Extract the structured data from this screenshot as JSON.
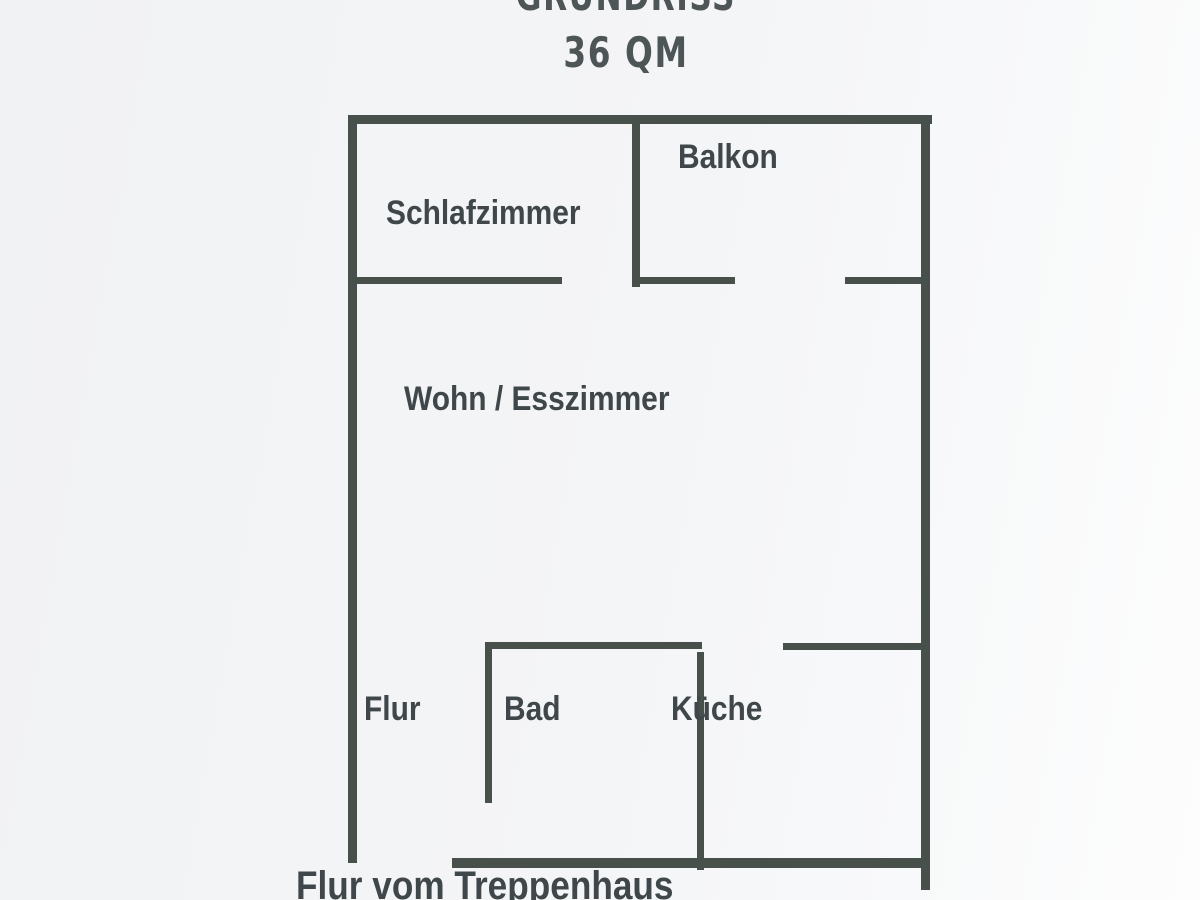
{
  "title": {
    "heading": "GRUNDRISS",
    "area": "36 QM"
  },
  "rooms": {
    "balkon": {
      "label": "Balkon"
    },
    "schlafzimmer": {
      "label": "Schlafzimmer"
    },
    "wohn_esszimmer": {
      "label": "Wohn / Esszimmer"
    },
    "flur": {
      "label": "Flur"
    },
    "bad": {
      "label": "Bad"
    },
    "kueche": {
      "label": "Küche"
    },
    "treppenhaus": {
      "label": "Flur vom Treppenhaus"
    }
  },
  "colors": {
    "wall": "#47504b",
    "label_text": "#3f474a",
    "title_text": "#4e5556",
    "background": "#f4f5f7"
  },
  "plan": {
    "walls": [
      {
        "name": "exterior-top-wall",
        "x": 348,
        "y": 115,
        "w": 584,
        "h": 9
      },
      {
        "name": "exterior-left-wall",
        "x": 348,
        "y": 115,
        "w": 9,
        "h": 748
      },
      {
        "name": "exterior-right-wall",
        "x": 921,
        "y": 117,
        "w": 9,
        "h": 773
      },
      {
        "name": "exterior-bottom-wall",
        "x": 452,
        "y": 858,
        "w": 478,
        "h": 10
      },
      {
        "name": "balkon-divider-wall",
        "x": 632,
        "y": 118,
        "w": 8,
        "h": 169
      },
      {
        "name": "schlafzimmer-south-wall",
        "x": 348,
        "y": 277,
        "w": 214,
        "h": 7
      },
      {
        "name": "balkon-south-wall-left",
        "x": 632,
        "y": 277,
        "w": 103,
        "h": 7
      },
      {
        "name": "balkon-south-wall-right",
        "x": 845,
        "y": 277,
        "w": 85,
        "h": 7
      },
      {
        "name": "bad-north-wall",
        "x": 485,
        "y": 642,
        "w": 217,
        "h": 7
      },
      {
        "name": "bad-west-wall",
        "x": 485,
        "y": 642,
        "w": 7,
        "h": 161
      },
      {
        "name": "bad-east-wall",
        "x": 697,
        "y": 652,
        "w": 7,
        "h": 218
      },
      {
        "name": "kueche-north-wall",
        "x": 783,
        "y": 643,
        "w": 138,
        "h": 7
      }
    ]
  }
}
